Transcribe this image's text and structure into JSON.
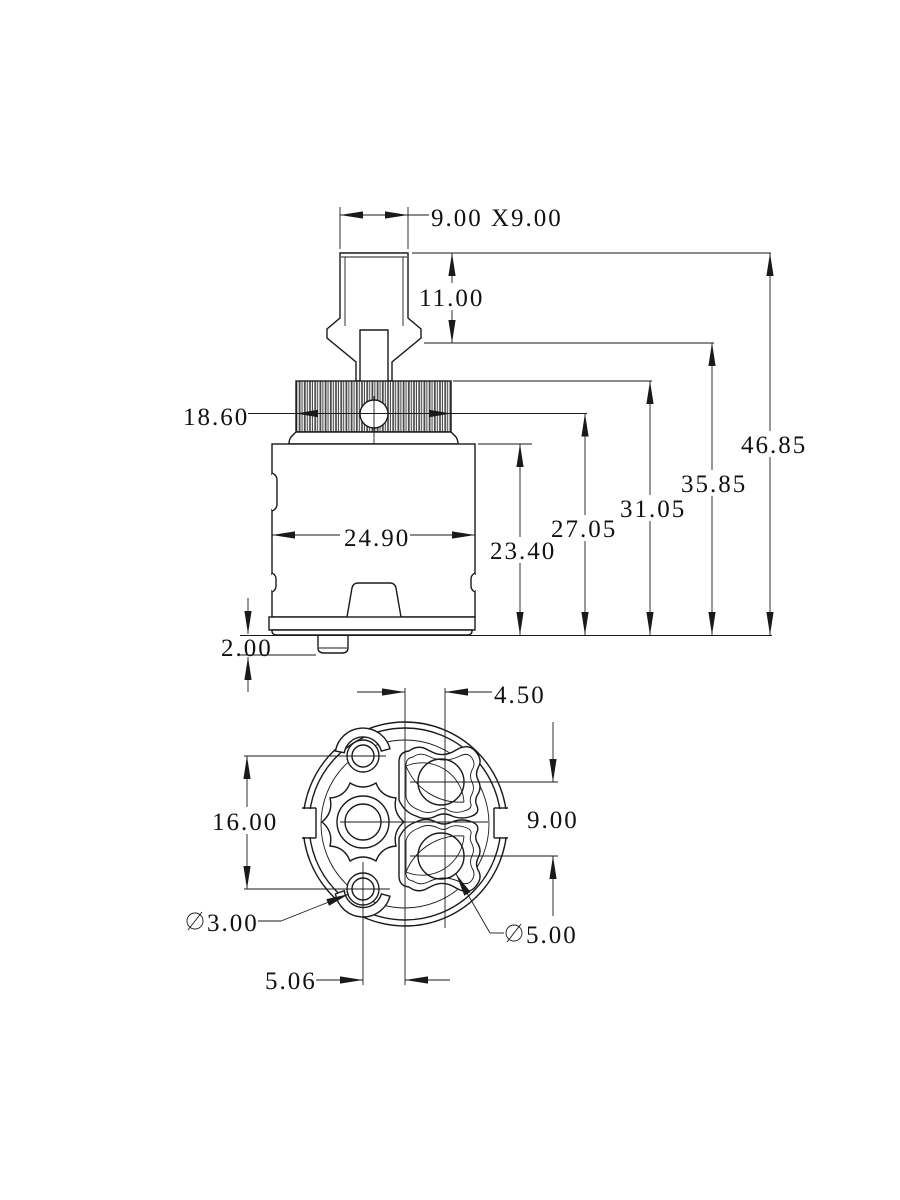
{
  "drawing": {
    "description": "Dimensioned 2D technical drawing of a ceramic faucet cartridge: side elevation view with splined snap-fit stem above, bottom face view with water ports below",
    "side_view": {
      "dim_stem_square": "9.00 X9.00",
      "dim_stem_height": "11.00",
      "dim_spline_width": "18.60",
      "dim_body_width": "24.90",
      "dim_body_height": "23.40",
      "dim_height_hole_center": "27.05",
      "dim_height_spline_top": "31.05",
      "dim_height_stem_base": "35.85",
      "dim_height_total": "46.85",
      "dim_base_tab_height": "2.00"
    },
    "bottom_view": {
      "dim_port_offset_x": "4.50",
      "dim_port_pitch_y": "9.00",
      "dim_screw_hole_pitch": "16.00",
      "dim_screw_hole_offset_x": "5.06",
      "dia_small_symbol": "⌀",
      "dia_small_value": "3.00",
      "dia_port_symbol": "⌀",
      "dia_port_value": "5.00"
    },
    "colors": {
      "line": "#1a1a1a",
      "background": "#ffffff"
    }
  }
}
